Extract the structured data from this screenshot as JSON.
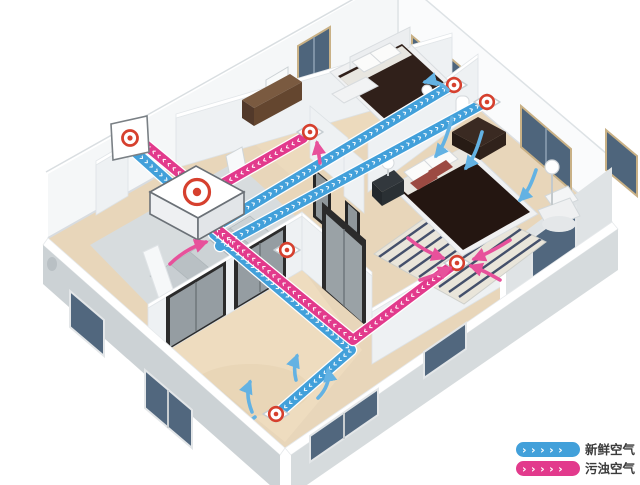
{
  "legend": {
    "fresh": {
      "label": "新鲜空气",
      "chevrons": "›››››"
    },
    "stale": {
      "label": "污浊空气",
      "chevrons": "›››››"
    }
  },
  "colors": {
    "fresh": "#42a0da",
    "stale": "#e23a8c",
    "fresh-arrow": "#63b2e3",
    "stale-arrow": "#e7519b",
    "vent-red": "#d6402e",
    "legend-text": "#3b3b3b"
  },
  "decor": {
    "chevrons": "››››››››››››››››››››››››››››››››››››››››››››››››››››››››››››››››››››››››››››››››››››››››››"
  }
}
